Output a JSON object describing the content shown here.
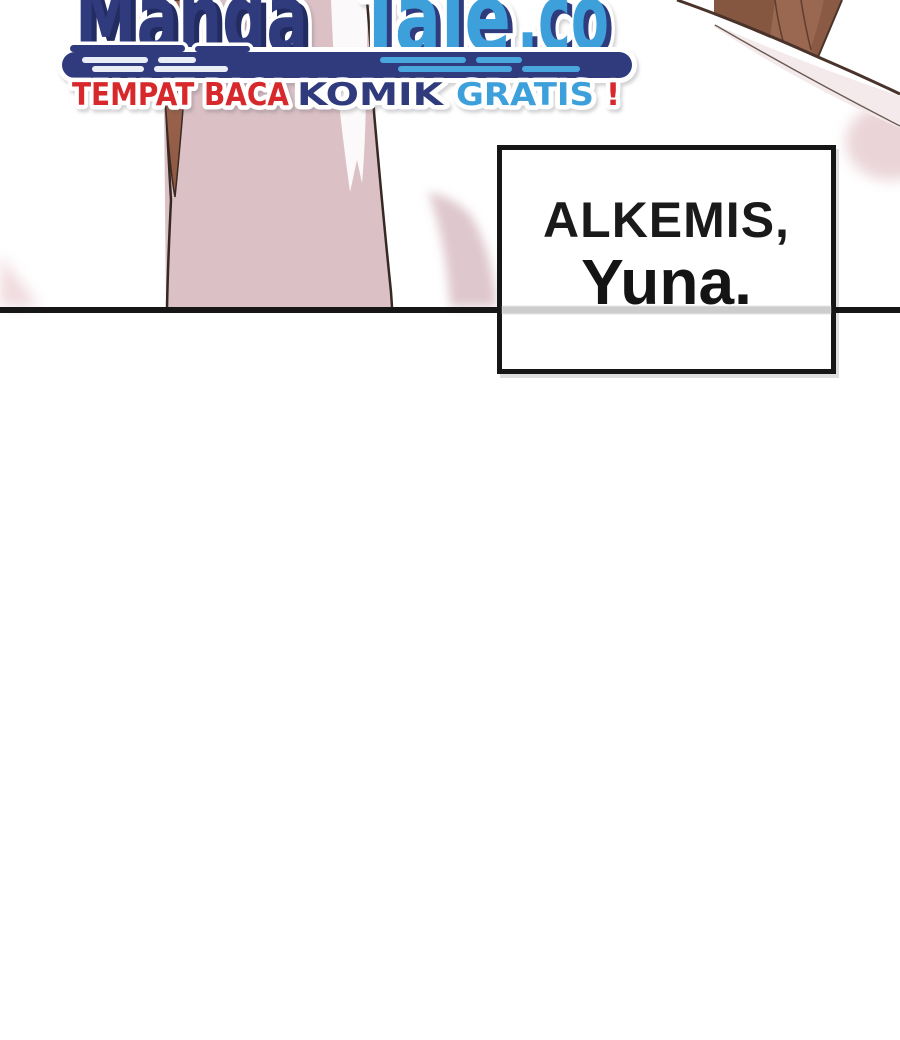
{
  "site_logo": {
    "brand": {
      "part1": "Manga",
      "part2": "Tale",
      "part3": ".co"
    },
    "tagline": {
      "part1": "TEMPAT BACA",
      "part2": "KOMIK",
      "part3": "GRATIS",
      "part4": "!"
    },
    "colors": {
      "navy": "#2f3b7d",
      "navy_shadow": "#232c61",
      "light_blue": "#3da0db",
      "red": "#d7282b"
    }
  },
  "speech_bubble": {
    "line1": "ALKEMIS,",
    "line2": "Yuna."
  },
  "artwork_colors": {
    "clothing_pink": "#dbc1c6",
    "highlight_white": "#fbf9f9",
    "hair_brown": "#9a6750",
    "hair_brown_dark": "#855640",
    "soft_pink": "#e8d2d7",
    "panel_line_black": "#161616",
    "outline_dark": "#362822"
  }
}
